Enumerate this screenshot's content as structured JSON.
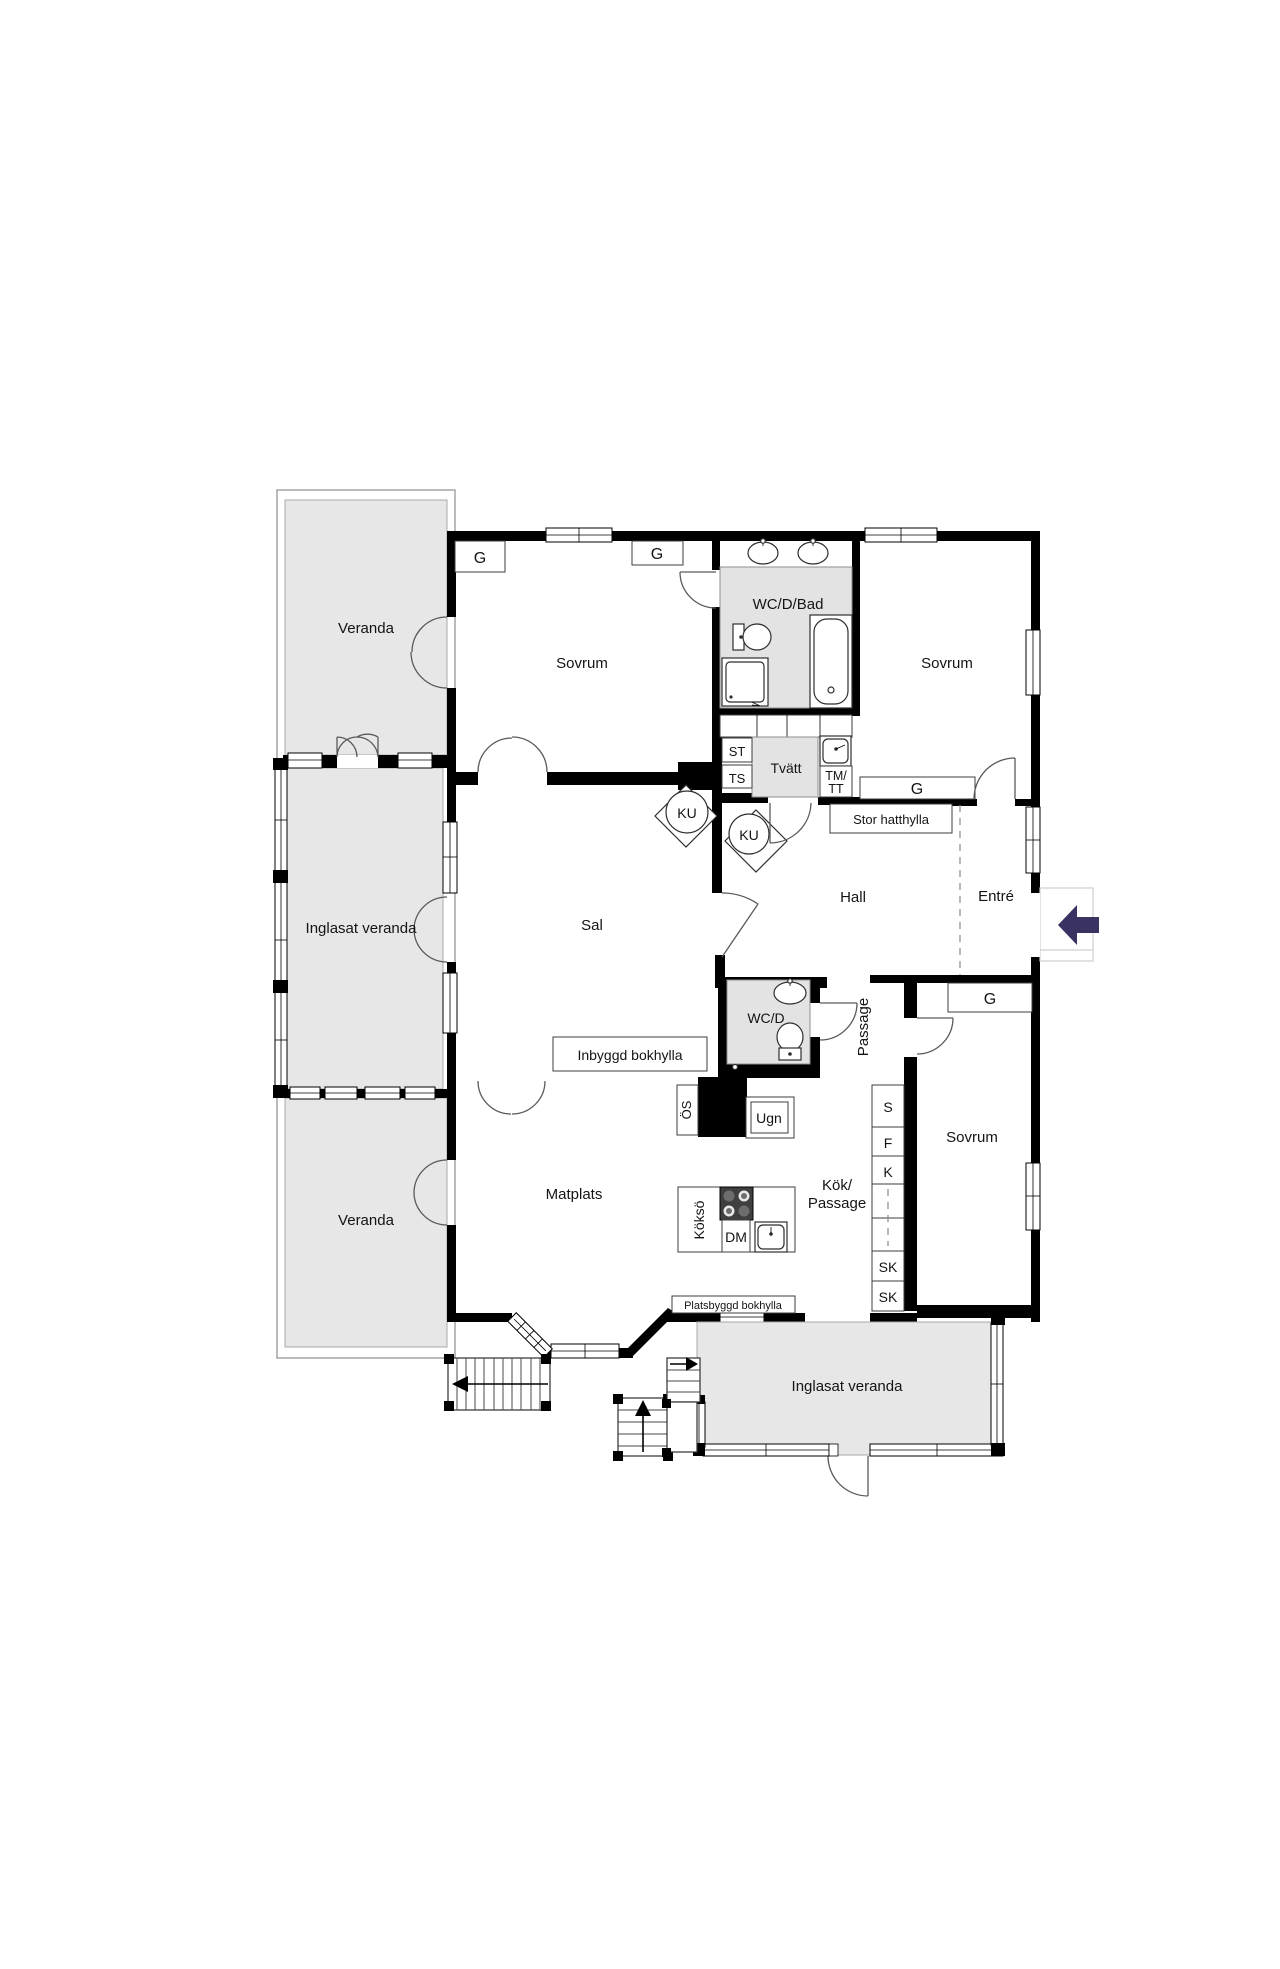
{
  "title": "Floor plan",
  "rooms": {
    "veranda": "Veranda",
    "inglasat_veranda": "Inglasat veranda",
    "sovrum": "Sovrum",
    "wc_d_bad": "WC/D/Bad",
    "tvatt": "Tvätt",
    "hall": "Hall",
    "entre": "Entré",
    "sal": "Sal",
    "wc_d": "WC/D",
    "passage": "Passage",
    "matplats": "Matplats",
    "kok_line1": "Kök/",
    "kok_line2": "Passage"
  },
  "cabinets": {
    "g": "G",
    "st": "ST",
    "ts": "TS",
    "tm_line1": "TM/",
    "tm_line2": "TT",
    "s": "S",
    "f": "F",
    "k": "K",
    "sk": "SK",
    "ku": "KU",
    "os": "ÖS",
    "ugn": "Ugn",
    "dm": "DM",
    "kokso": "Köksö"
  },
  "builtins": {
    "stor_hatthylla": "Stor hatthylla",
    "inbyggd_bokhylla": "Inbyggd bokhylla",
    "platsbyggd_bokhylla": "Platsbyggd bokhylla"
  },
  "colors": {
    "wall": "#000000",
    "veranda_fill": "#e7e7e7",
    "wetroom_fill": "#e3e3e3",
    "entry_arrow": "#3b3264",
    "door_swing": "#5a5a5a",
    "frame_line": "#9e9e9e"
  }
}
